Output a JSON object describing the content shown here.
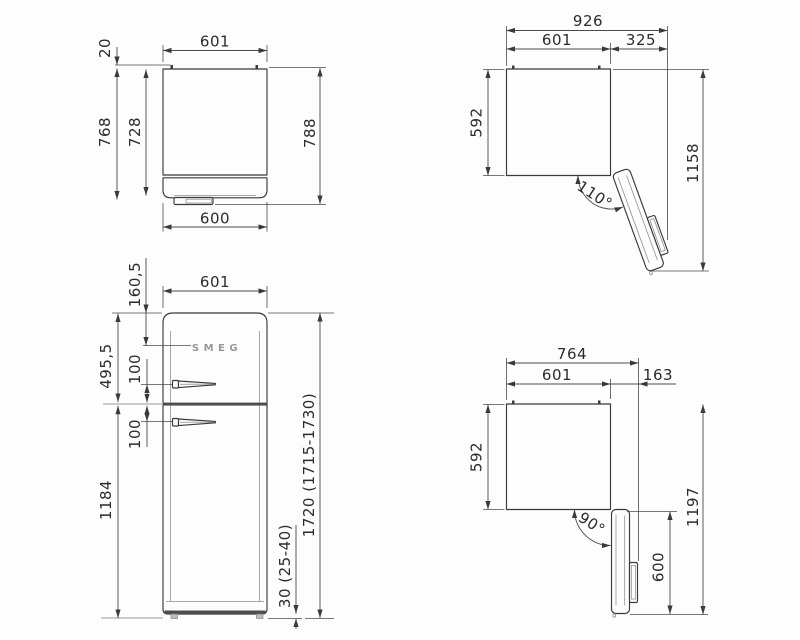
{
  "title": "Refrigerator dimension drawing",
  "colors": {
    "line": "#3a3a3a",
    "dim_line": "#4a4a4a",
    "text": "#2b2b2b",
    "gray_extension": "#b7bbbb",
    "door_split_band": "#4d4d4d",
    "logo": "#989898",
    "background": "#fdfdfd"
  },
  "views": {
    "top": {
      "width_top": "601",
      "rear_gap": "20",
      "depth_to_door": "768",
      "body_depth": "728",
      "total_depth": "788",
      "width_bottom": "600"
    },
    "open110": {
      "total_width": "926",
      "body_width": "601",
      "door_swing": "325",
      "depth": "592",
      "total_reach": "1158",
      "angle": "110°"
    },
    "front": {
      "width": "601",
      "logo_offset": "160,5",
      "upper_door": "495,5",
      "handle_gap_upper": "100",
      "handle_gap_lower": "100",
      "lower_door": "1184",
      "height": "1720 (1715-1730)",
      "feet": "30 (25-40)",
      "brand": "SMEG"
    },
    "open90": {
      "total_width": "764",
      "body_width": "601",
      "door_swing": "163",
      "depth": "592",
      "total_reach": "1197",
      "door_length": "600",
      "angle": "90°"
    }
  }
}
